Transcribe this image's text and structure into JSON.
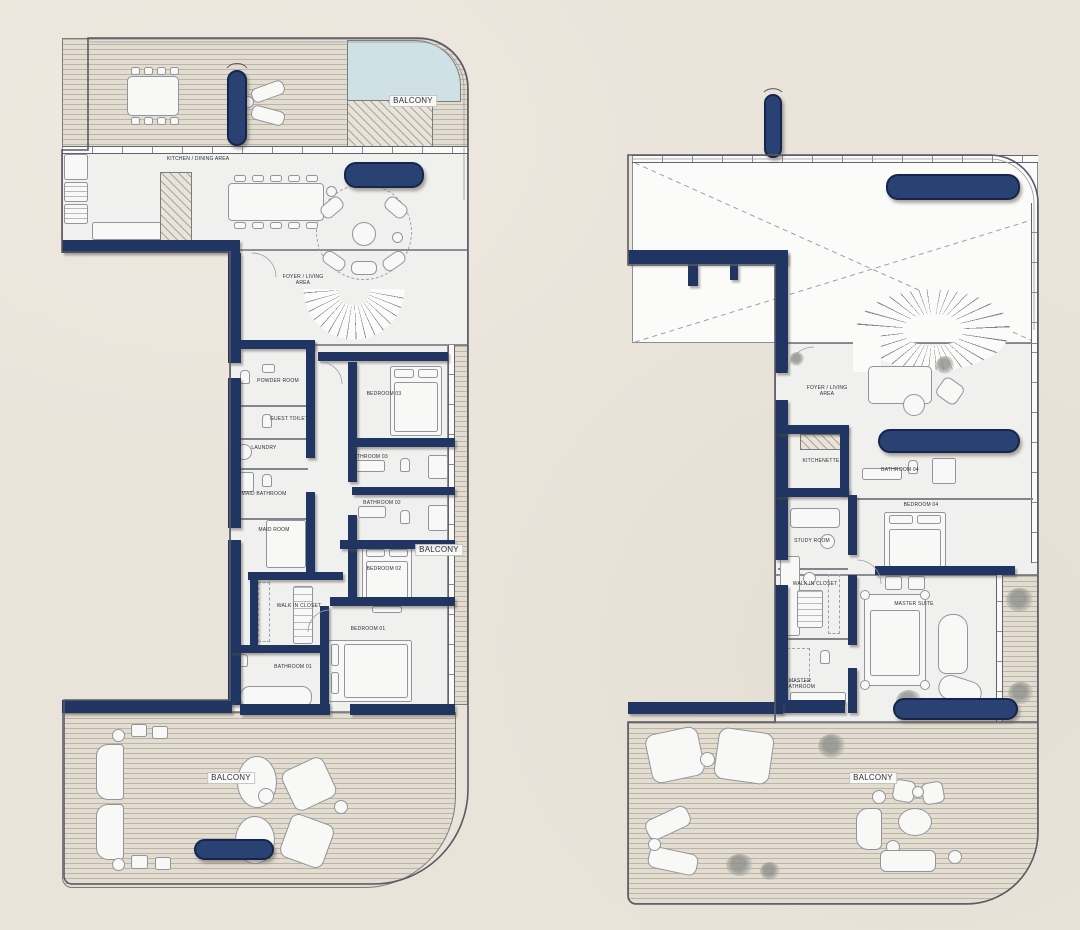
{
  "palette": {
    "background": "#e9e3da",
    "wall_navy": "#203561",
    "planter_navy": "#2a4173",
    "deck": "#e2dcd1",
    "interior": "#f0f0ee",
    "pool_blue": "#cfe1e5",
    "line_gray": "#84858c",
    "label_color": "#2e3136"
  },
  "left_plan": {
    "labels": {
      "balcony_top": "BALCONY",
      "kitchen_dining": "KITCHEN / DINING AREA",
      "foyer_living": "FOYER / LIVING AREA",
      "powder_room": "POWDER ROOM",
      "guest_toilet": "GUEST TOILET",
      "laundry": "LAUNDRY",
      "maid_bathroom": "MAID BATHROOM",
      "maid_room": "MAID ROOM",
      "bedroom_03": "BEDROOM 03",
      "bathroom_03": "BATHROOM 03",
      "bathroom_02": "BATHROOM 02",
      "bedroom_02": "BEDROOM 02",
      "walk_in_closet": "WALK IN CLOSET",
      "bathroom_01": "BATHROOM 01",
      "bedroom_01": "BEDROOM 01",
      "balcony_right": "BALCONY",
      "balcony_bottom": "BALCONY"
    }
  },
  "right_plan": {
    "labels": {
      "foyer_living": "FOYER / LIVING AREA",
      "kitchenette": "KITCHENETTE",
      "bathroom_04": "BATHROOM 04",
      "bedroom_04": "BEDROOM 04",
      "study_room": "STUDY ROOM",
      "walk_in_closet": "WALK IN CLOSET",
      "master_suite": "MASTER SUITE",
      "master_bathroom": "MASTER BATHROOM",
      "balcony_bottom": "BALCONY"
    }
  }
}
